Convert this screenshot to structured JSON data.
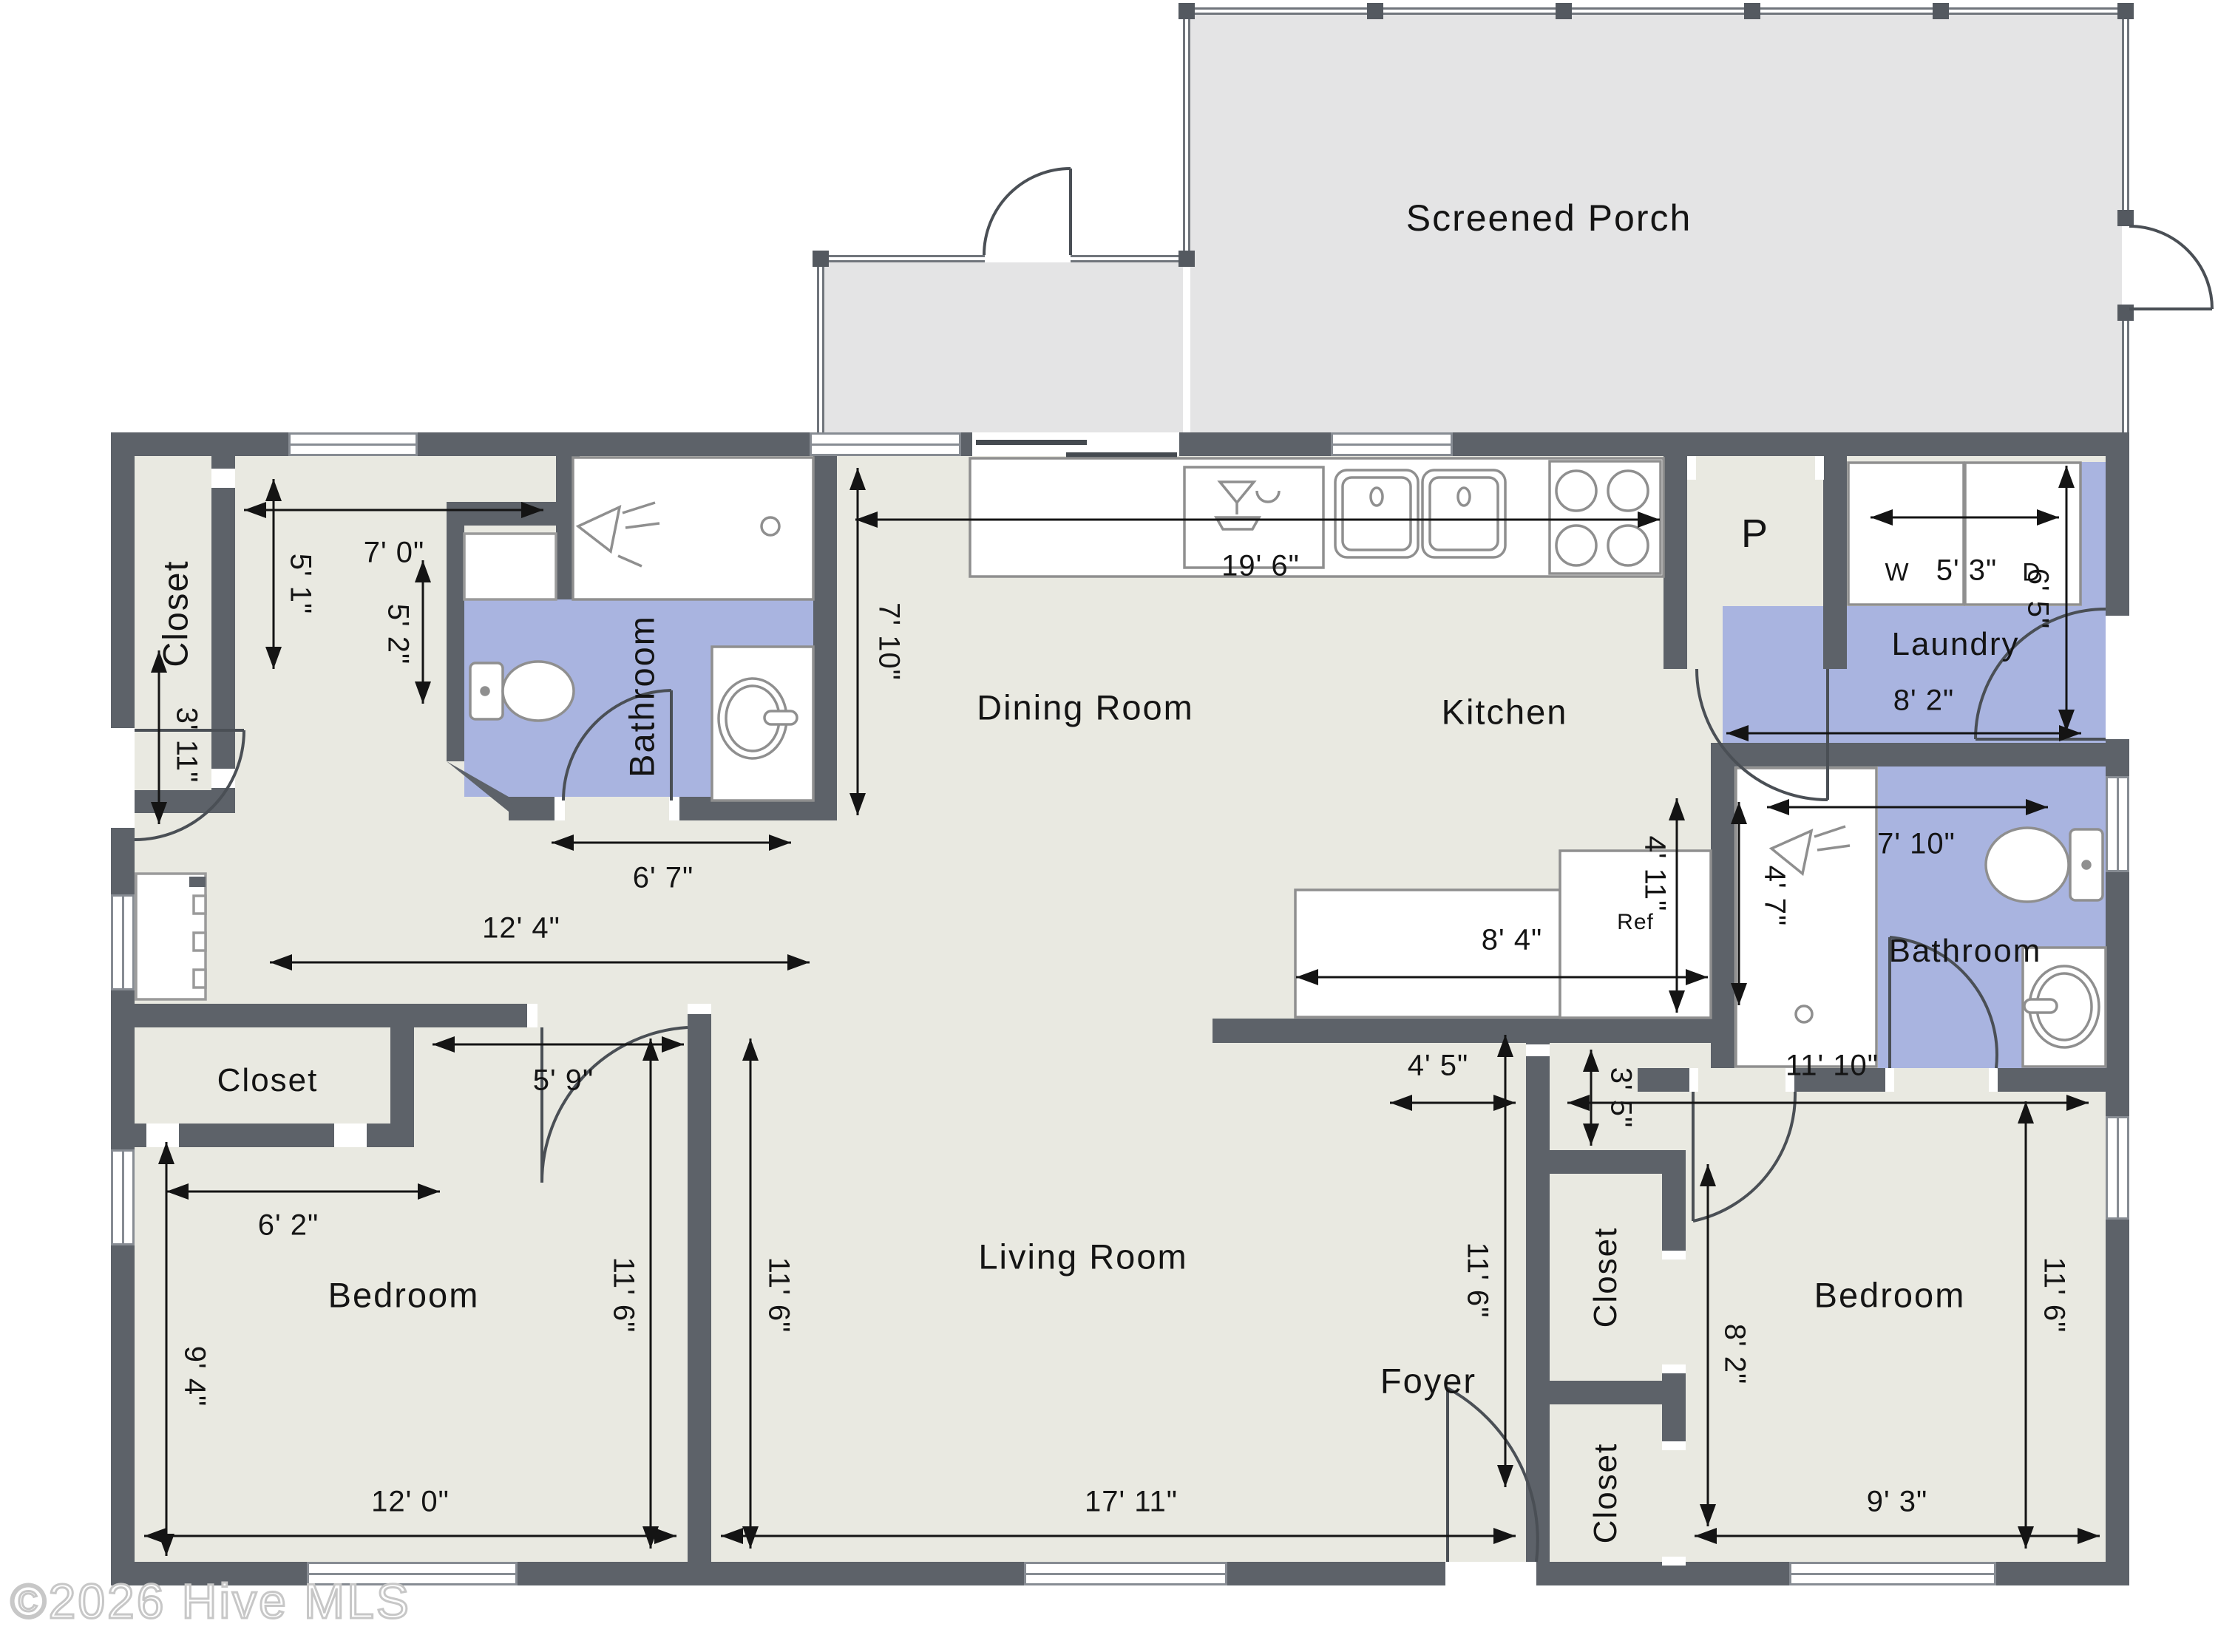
{
  "watermark": "©2026 Hive MLS",
  "rooms": {
    "screened_porch": "Screened Porch",
    "dining_room": "Dining Room",
    "kitchen": "Kitchen",
    "pantry": "P",
    "laundry": "Laundry",
    "bathroom_left": "Bathroom",
    "bathroom_right": "Bathroom",
    "closet_top_left": "Closet",
    "closet_mid_left": "Closet",
    "closet_right_upper": "Closet",
    "closet_right_lower": "Closet",
    "bedroom_left": "Bedroom",
    "bedroom_right": "Bedroom",
    "living_room": "Living Room",
    "foyer": "Foyer"
  },
  "appliances": {
    "washer": "W",
    "dryer": "D",
    "refrigerator": "Ref"
  },
  "dims": {
    "closet_tl_width": "7' 0\"",
    "closet_tl_depth": "5' 1\"",
    "bath_left_depth": "5' 2\"",
    "bath_left_width": "6' 7\"",
    "side_door": "3' 11\"",
    "hall_left_width": "12' 4\"",
    "dining_depth": "7' 10\"",
    "kitchen_run": "19' 6\"",
    "wd_width": "5' 3\"",
    "laundry_depth": "6' 5\"",
    "laundry_width": "8' 2\"",
    "bath_right_width": "7' 10\"",
    "shower_right_depth": "4' 7\"",
    "counter_width": "8' 4\"",
    "counter_depth": "4' 11\"",
    "hall_right_opening": "4' 5\"",
    "hall_right_jog": "3' 5\"",
    "hall_right_width": "11' 10\"",
    "bedroom_left_door_wall": "5' 9\"",
    "closet_mid_width": "6' 2\"",
    "bedroom_left_depth": "9' 4\"",
    "bedroom_left_height": "11' 6\"",
    "living_height_left": "11' 6\"",
    "living_height_right": "11' 6\"",
    "bedroom_right_closet_depth": "8' 2\"",
    "bedroom_right_height": "11' 6\"",
    "bedroom_left_width": "12' 0\"",
    "living_width": "17' 11\"",
    "bedroom_right_width": "9' 3\""
  }
}
